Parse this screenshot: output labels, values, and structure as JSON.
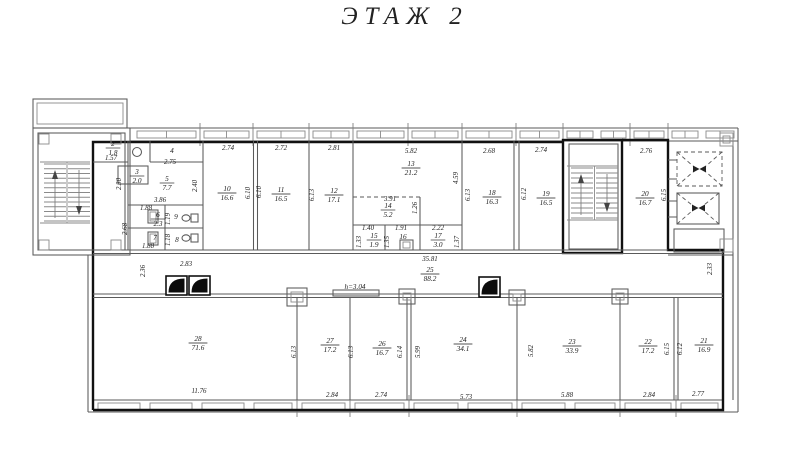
{
  "title": "ЭТАЖ 2",
  "colors": {
    "line": "#5a5a5a",
    "bold_outline": "#111111",
    "annotation_blue": "#3a3ab0",
    "background": "#ffffff"
  },
  "annotations": [
    {
      "text": "h=3.04",
      "x": 355,
      "y": 289
    }
  ],
  "rooms": [
    {
      "num": "2",
      "area": "1.8",
      "x": 113,
      "y": 146
    },
    {
      "num": "3",
      "area": "2.0",
      "x": 137,
      "y": 174
    },
    {
      "num": "4",
      "x": 172,
      "y": 153
    },
    {
      "num": "5",
      "area": "7.7",
      "x": 167,
      "y": 181
    },
    {
      "num": "6",
      "area": "2.3",
      "x": 158,
      "y": 217
    },
    {
      "num": "7",
      "x": 155,
      "y": 240
    },
    {
      "num": "8",
      "x": 177,
      "y": 242
    },
    {
      "num": "9",
      "x": 176,
      "y": 219
    },
    {
      "num": "10",
      "area": "16.6",
      "x": 227,
      "y": 191
    },
    {
      "num": "11",
      "area": "16.5",
      "x": 281,
      "y": 192
    },
    {
      "num": "12",
      "area": "17.1",
      "x": 334,
      "y": 193
    },
    {
      "num": "13",
      "area": "21.2",
      "x": 411,
      "y": 166
    },
    {
      "num": "14",
      "area": "5.2",
      "x": 388,
      "y": 208
    },
    {
      "num": "15",
      "area": "1.9",
      "x": 374,
      "y": 238
    },
    {
      "num": "16",
      "x": 403,
      "y": 239
    },
    {
      "num": "17",
      "area": "3.0",
      "x": 438,
      "y": 238
    },
    {
      "num": "18",
      "area": "16.3",
      "x": 492,
      "y": 195
    },
    {
      "num": "19",
      "area": "16.5",
      "x": 546,
      "y": 196
    },
    {
      "num": "20",
      "area": "16.7",
      "x": 645,
      "y": 196
    },
    {
      "num": "21",
      "area": "16.9",
      "x": 704,
      "y": 343
    },
    {
      "num": "22",
      "area": "17.2",
      "x": 648,
      "y": 344
    },
    {
      "num": "23",
      "area": "33.9",
      "x": 572,
      "y": 344
    },
    {
      "num": "24",
      "area": "34.1",
      "x": 463,
      "y": 342
    },
    {
      "num": "25",
      "area": "88.2",
      "x": 430,
      "y": 272
    },
    {
      "num": "26",
      "area": "16.7",
      "x": 382,
      "y": 346
    },
    {
      "num": "27",
      "area": "17.2",
      "x": 330,
      "y": 343
    },
    {
      "num": "28",
      "area": "71.6",
      "x": 198,
      "y": 341
    }
  ],
  "dims": [
    {
      "t": "1.57",
      "x": 111,
      "y": 160
    },
    {
      "t": "2.75",
      "x": 170,
      "y": 164
    },
    {
      "t": "2.30",
      "x": 121,
      "y": 184,
      "r": 1
    },
    {
      "t": "2.40",
      "x": 197,
      "y": 186,
      "r": 1
    },
    {
      "t": "3.86",
      "x": 160,
      "y": 202
    },
    {
      "t": "1.88",
      "x": 146,
      "y": 210
    },
    {
      "t": "1.88",
      "x": 148,
      "y": 248
    },
    {
      "t": "2.68",
      "x": 127,
      "y": 229,
      "r": 1
    },
    {
      "t": "1.19",
      "x": 170,
      "y": 219,
      "r": 1
    },
    {
      "t": "1.18",
      "x": 170,
      "y": 240,
      "r": 1
    },
    {
      "t": "2.74",
      "x": 228,
      "y": 150
    },
    {
      "t": "2.72",
      "x": 281,
      "y": 150
    },
    {
      "t": "2.81",
      "x": 334,
      "y": 150
    },
    {
      "t": "5.82",
      "x": 411,
      "y": 153
    },
    {
      "t": "2.68",
      "x": 489,
      "y": 153
    },
    {
      "t": "2.74",
      "x": 541,
      "y": 152
    },
    {
      "t": "2.76",
      "x": 646,
      "y": 153
    },
    {
      "t": "6.10",
      "x": 250,
      "y": 193,
      "r": 1
    },
    {
      "t": "6.10",
      "x": 261,
      "y": 192,
      "r": 1
    },
    {
      "t": "6.13",
      "x": 314,
      "y": 195,
      "r": 1
    },
    {
      "t": "4.59",
      "x": 458,
      "y": 178,
      "r": 1
    },
    {
      "t": "6.13",
      "x": 470,
      "y": 195,
      "r": 1
    },
    {
      "t": "6.12",
      "x": 526,
      "y": 194,
      "r": 1
    },
    {
      "t": "6.15",
      "x": 666,
      "y": 195,
      "r": 1
    },
    {
      "t": "3.91",
      "x": 390,
      "y": 201
    },
    {
      "t": "1.26",
      "x": 417,
      "y": 208,
      "r": 1
    },
    {
      "t": "1.40",
      "x": 368,
      "y": 230
    },
    {
      "t": "1.91",
      "x": 401,
      "y": 230
    },
    {
      "t": "2.22",
      "x": 438,
      "y": 230
    },
    {
      "t": "1.33",
      "x": 361,
      "y": 242,
      "r": 1
    },
    {
      "t": "1.35",
      "x": 389,
      "y": 242,
      "r": 1
    },
    {
      "t": "1.37",
      "x": 459,
      "y": 242,
      "r": 1
    },
    {
      "t": "35.81",
      "x": 430,
      "y": 261
    },
    {
      "t": "2.83",
      "x": 186,
      "y": 266
    },
    {
      "t": "2.36",
      "x": 145,
      "y": 271,
      "r": 1
    },
    {
      "t": "2.33",
      "x": 712,
      "y": 269,
      "r": 1
    },
    {
      "t": "6.13",
      "x": 296,
      "y": 352,
      "r": 1
    },
    {
      "t": "6.13",
      "x": 353,
      "y": 352,
      "r": 1
    },
    {
      "t": "6.14",
      "x": 402,
      "y": 352,
      "r": 1
    },
    {
      "t": "5.99",
      "x": 420,
      "y": 352,
      "r": 1
    },
    {
      "t": "5.82",
      "x": 533,
      "y": 351,
      "r": 1
    },
    {
      "t": "6.15",
      "x": 669,
      "y": 349,
      "r": 1
    },
    {
      "t": "6.12",
      "x": 682,
      "y": 349,
      "r": 1
    },
    {
      "t": "11.76",
      "x": 199,
      "y": 393
    },
    {
      "t": "2.84",
      "x": 332,
      "y": 397
    },
    {
      "t": "2.74",
      "x": 381,
      "y": 397
    },
    {
      "t": "5.73",
      "x": 466,
      "y": 399
    },
    {
      "t": "5.88",
      "x": 567,
      "y": 397
    },
    {
      "t": "2.84",
      "x": 649,
      "y": 397
    },
    {
      "t": "2.77",
      "x": 698,
      "y": 396
    }
  ]
}
